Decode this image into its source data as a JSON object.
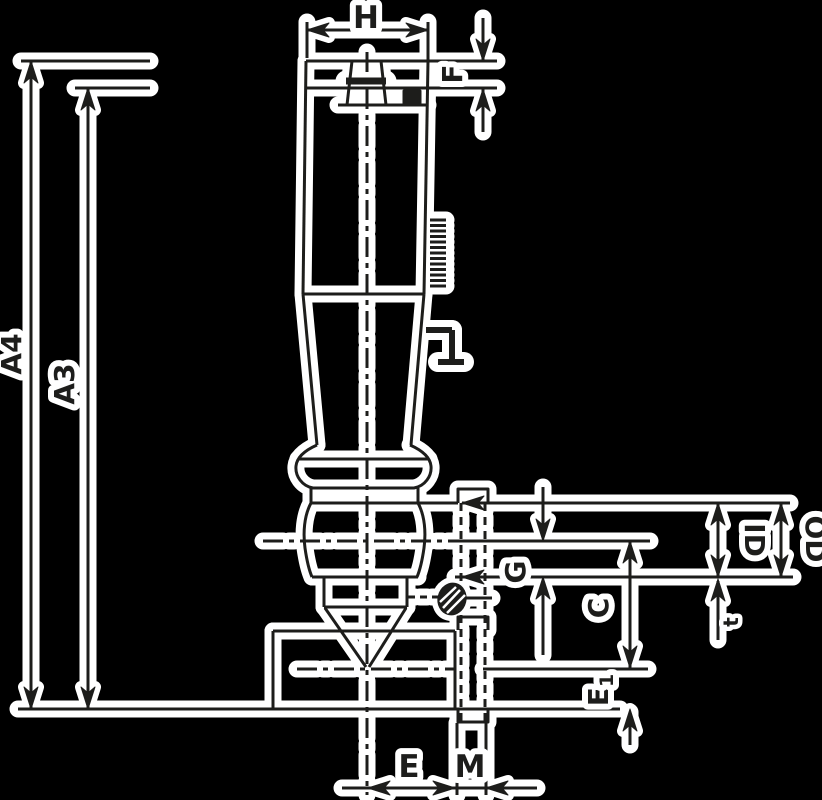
{
  "meta": {
    "kind": "technical-dimension-drawing",
    "part": "vertical shank with flange, head, cone seat and base block"
  },
  "colors": {
    "background": "#000000",
    "ink": "#1d1d1b",
    "halo": "#ffffff"
  },
  "labels": {
    "h": "H",
    "f": "F",
    "a4": "A4",
    "a3": "A3",
    "g": "G",
    "c": "C",
    "id": "ID",
    "od": "OD",
    "t": "t",
    "e1_base": "E",
    "e1_sub": "1",
    "e": "E",
    "m": "M"
  },
  "dimension_callouts": [
    {
      "label": "H",
      "orientation": "horizontal, top width"
    },
    {
      "label": "F",
      "orientation": "vertical, head height, right of top"
    },
    {
      "label": "A4",
      "orientation": "vertical, outer left, full length"
    },
    {
      "label": "A3",
      "orientation": "vertical, inner left, shoulder to base"
    },
    {
      "label": "G",
      "orientation": "vertical, center-right small span"
    },
    {
      "label": "C",
      "orientation": "vertical, right, gauge line to cone tip"
    },
    {
      "label": "ID",
      "orientation": "vertical, far right inner arrow"
    },
    {
      "label": "OD",
      "orientation": "vertical, far right outer arrow"
    },
    {
      "label": "t",
      "orientation": "vertical, small, below flange line"
    },
    {
      "label": "E1",
      "orientation": "vertical, lower right"
    },
    {
      "label": "E",
      "orientation": "horizontal, bottom, centerline to slot"
    },
    {
      "label": "M",
      "orientation": "horizontal, bottom, slot width"
    }
  ]
}
